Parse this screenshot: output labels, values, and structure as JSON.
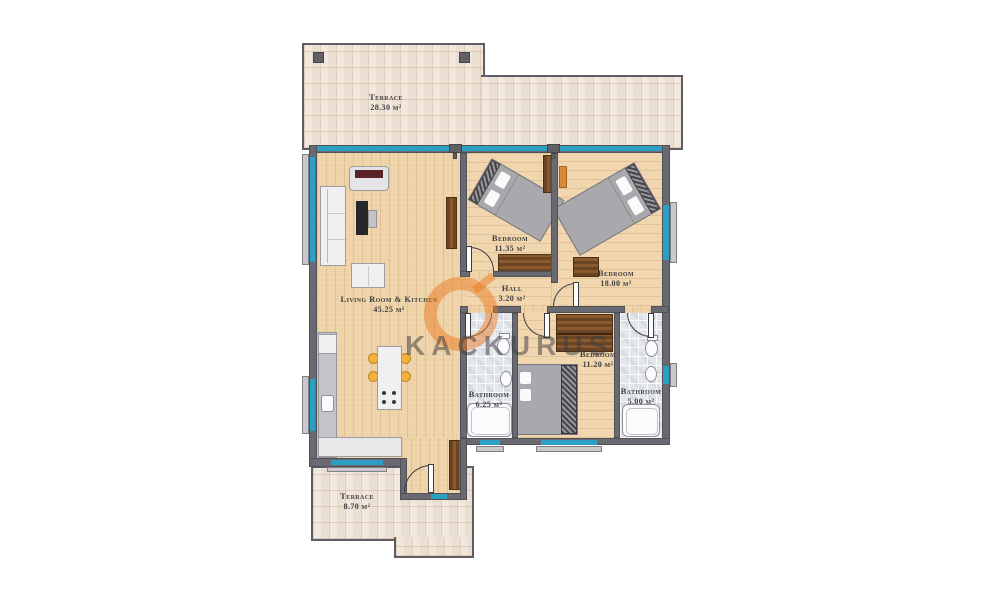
{
  "plan_title": "apartment-floor-plan",
  "rooms": {
    "terrace_top": {
      "name": "Terrace",
      "area": "28.30 m²"
    },
    "living": {
      "name": "Living Room & Kitchen",
      "area": "45.25 m²"
    },
    "bedroom_1": {
      "name": "Bedroom",
      "area": "11.35 m²"
    },
    "hall": {
      "name": "Hall",
      "area": "3.20 m²"
    },
    "bedroom_2": {
      "name": "Bedroom",
      "area": "18.00 m²"
    },
    "bedroom_3": {
      "name": "Bedroom",
      "area": "11.20 m²"
    },
    "bathroom_1": {
      "name": "Bathroom",
      "area": "6.25 m²"
    },
    "bathroom_2": {
      "name": "Bathroom",
      "area": "5.00 m²"
    },
    "terrace_bottom": {
      "name": "Terrace",
      "area": "8.70 m²"
    }
  },
  "watermark": {
    "text": "KACKURUS",
    "logo": "orange-ring-logo"
  },
  "colors": {
    "window_teal": "#2ba0c4",
    "wall_gray": "#696971",
    "wood_floor": "#efd3a8",
    "terrace_tile": "#ebdfd2",
    "bathroom_tile": "#e3e6ea",
    "watermark_orange": "#e97a22",
    "label_text": "#3e3e40"
  }
}
